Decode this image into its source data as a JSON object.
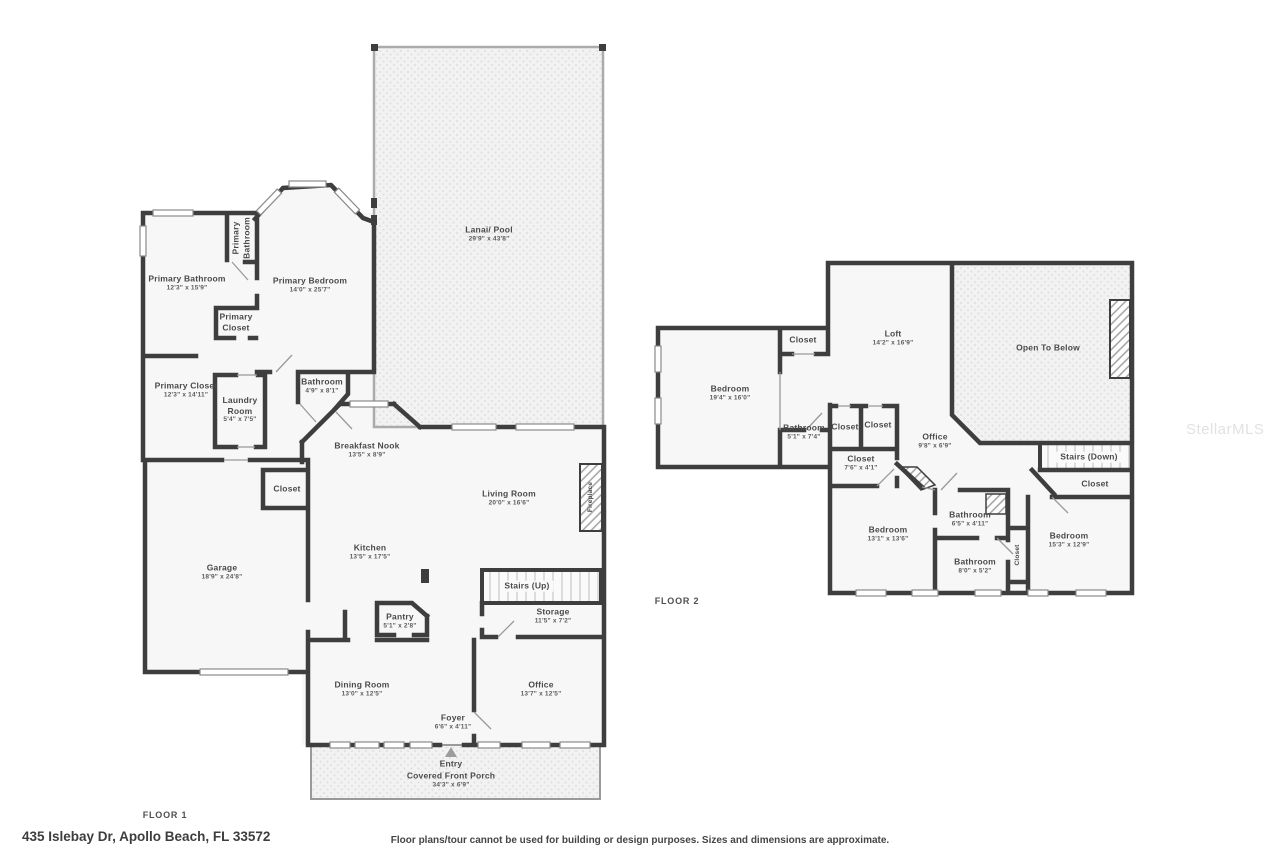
{
  "meta": {
    "address": "435 Islebay Dr, Apollo Beach, FL 33572",
    "disclaimer": "Floor plans/tour cannot be used for building or design purposes. Sizes and dimensions are approximate.",
    "watermark": "StellarMLS"
  },
  "colors": {
    "wall": "#3e3e3e",
    "room_fill": "#f7f7f7",
    "textured_fill": "#f2f2f2",
    "label_text": "#4a4a4a"
  },
  "floor1": {
    "label": "FLOOR 1",
    "rooms": [
      {
        "name": "Lanai/ Pool",
        "dims": "29'9\" x 43'8\""
      },
      {
        "name": "Primary Bathroom",
        "dims": "12'3\" x 15'9\""
      },
      {
        "name": "Primary Bathroom",
        "dims": ""
      },
      {
        "name": "Primary Bedroom",
        "dims": "14'0\" x 25'7\""
      },
      {
        "name": "Primary Closet",
        "dims": ""
      },
      {
        "name": "Primary Closet",
        "dims": "12'3\" x 14'11\""
      },
      {
        "name": "Laundry Room",
        "dims": "5'4\" x 7'5\""
      },
      {
        "name": "Bathroom",
        "dims": "4'9\" x 8'1\""
      },
      {
        "name": "Breakfast Nook",
        "dims": "13'5\" x 8'9\""
      },
      {
        "name": "Living Room",
        "dims": "20'0\" x 16'6\""
      },
      {
        "name": "Fireplace",
        "dims": ""
      },
      {
        "name": "Kitchen",
        "dims": "13'5\" x 17'5\""
      },
      {
        "name": "Closet",
        "dims": ""
      },
      {
        "name": "Garage",
        "dims": "18'9\" x 24'8\""
      },
      {
        "name": "Stairs (Up)",
        "dims": ""
      },
      {
        "name": "Storage",
        "dims": "11'5\" x 7'2\""
      },
      {
        "name": "Pantry",
        "dims": "5'1\" x 2'8\""
      },
      {
        "name": "Dining Room",
        "dims": "13'0\" x 12'5\""
      },
      {
        "name": "Office",
        "dims": "13'7\" x 12'5\""
      },
      {
        "name": "Foyer",
        "dims": "6'6\" x 4'11\""
      },
      {
        "name": "Entry",
        "dims": ""
      },
      {
        "name": "Covered Front Porch",
        "dims": "34'3\" x 6'9\""
      }
    ]
  },
  "floor2": {
    "label": "FLOOR 2",
    "rooms": [
      {
        "name": "Bedroom",
        "dims": "19'4\" x 16'0\""
      },
      {
        "name": "Closet",
        "dims": ""
      },
      {
        "name": "Loft",
        "dims": "14'2\" x 16'9\""
      },
      {
        "name": "Open To Below",
        "dims": ""
      },
      {
        "name": "Bathroom",
        "dims": "5'1\" x 7'4\""
      },
      {
        "name": "Closet",
        "dims": ""
      },
      {
        "name": "Closet",
        "dims": ""
      },
      {
        "name": "Closet",
        "dims": "7'6\" x 4'1\""
      },
      {
        "name": "Office",
        "dims": "9'8\" x 6'9\""
      },
      {
        "name": "Stairs (Down)",
        "dims": ""
      },
      {
        "name": "Closet",
        "dims": ""
      },
      {
        "name": "Bedroom",
        "dims": "13'1\" x 13'6\""
      },
      {
        "name": "Bathroom",
        "dims": "6'5\" x 4'11\""
      },
      {
        "name": "Bathroom",
        "dims": "8'0\" x 5'2\""
      },
      {
        "name": "Closet",
        "dims": ""
      },
      {
        "name": "Bedroom",
        "dims": "15'3\" x 12'9\""
      }
    ]
  }
}
